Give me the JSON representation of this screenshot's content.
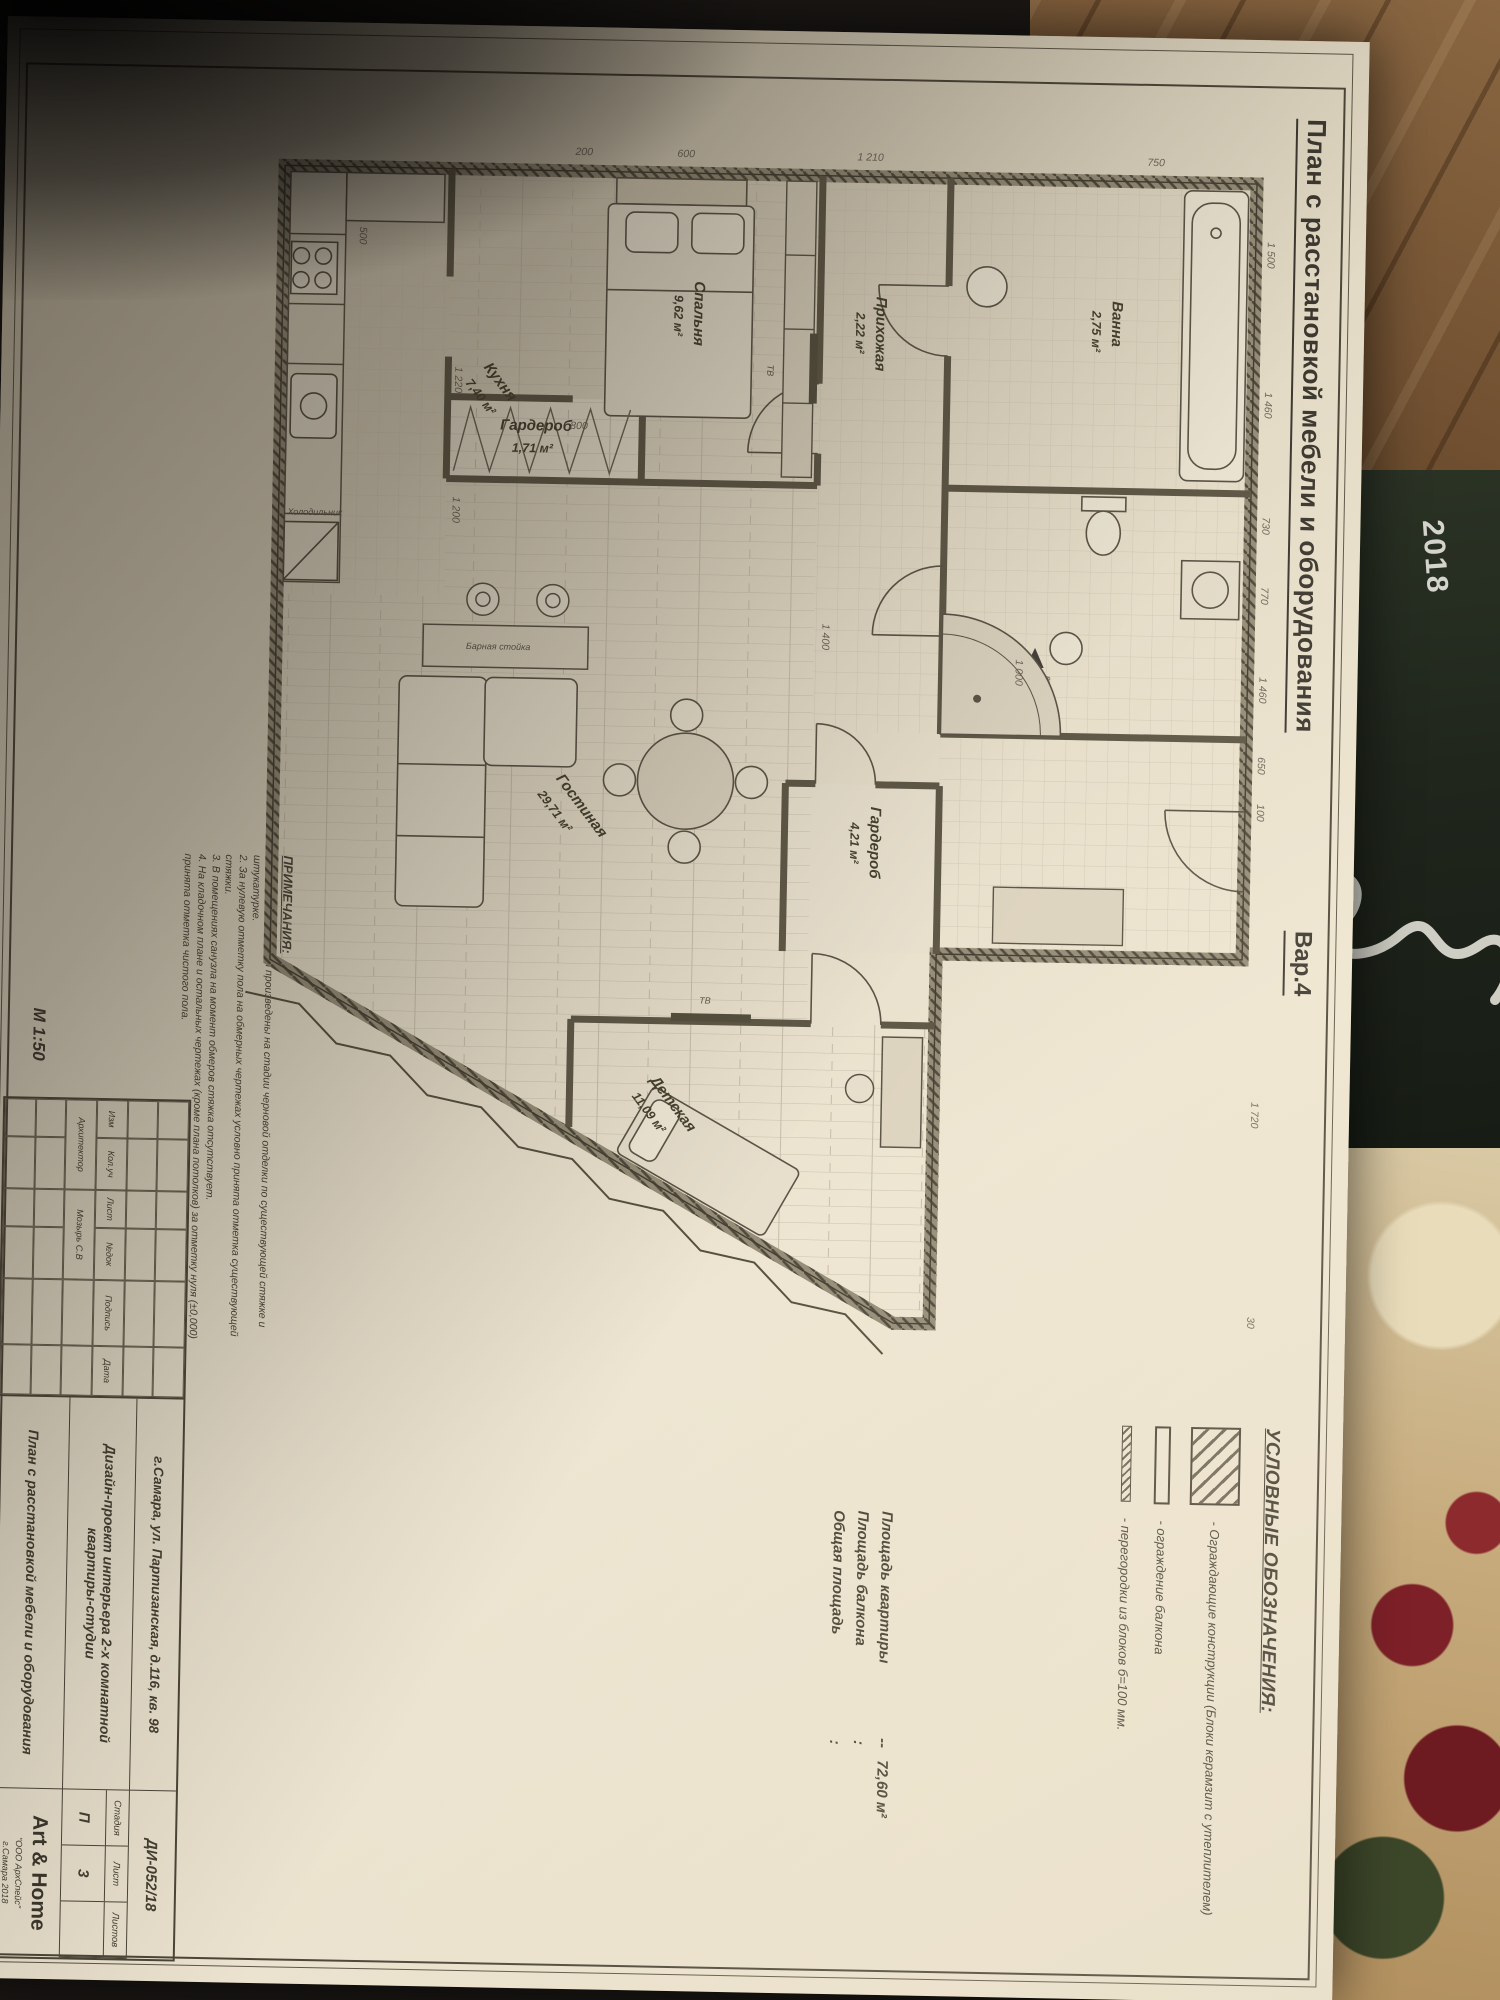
{
  "background": {
    "magazine_year": "2018"
  },
  "sheet": {
    "title": "План с расстановкой мебели и оборудования",
    "variant": "Вар.4",
    "scale": "М 1:50",
    "legend": {
      "heading": "УСЛОВНЫЕ ОБОЗНАЧЕНИЯ:",
      "items": [
        {
          "label": "- Ограждающие конструкции (Блоки керамзит с утеплителем)"
        },
        {
          "label": "- ограждение балкона"
        },
        {
          "label": "- перегородки из блоков б=100 мм."
        }
      ]
    },
    "areas": {
      "rows": [
        {
          "label": "Площадь квартиры",
          "sep": "--",
          "value": "72,60 м²"
        },
        {
          "label": "Площадь балкона",
          "sep": ":",
          "value": ""
        },
        {
          "label": "Общая площадь",
          "sep": ":",
          "value": ""
        }
      ]
    },
    "notes": {
      "heading": "ПРИМЕЧАНИЯ:",
      "items": [
        "1. Обмеры помещения произведены на стадии черновой отделки по существующей стяжке и штукатурке.",
        "2. За нулевую отметку пола на обмерных чертежах условно принята отметка существующей стяжки.",
        "3. В помещениях санузла на момент обмеров стяжка отсутствует.",
        "4. На кладочном плане и остальных чертежах (кроме плана потолков) за отметку нуля (±0,000) принята отметка чистого пола."
      ]
    },
    "stamp": {
      "address": "г.Самара, ул. Партизанская, д.116, кв. 98",
      "doc_no": "ДИ-052/18",
      "project": "Дизайн-проект интерьера 2-х комнатной квартиры-студии",
      "sheet_name": "План с расстановкой мебели и оборудования",
      "stage_label": "Стадия",
      "sheet_label": "Лист",
      "sheets_label": "Листов",
      "stage": "П",
      "sheet_no": "3",
      "sheets_total": "",
      "company": "Art & Home",
      "company_sub": "\"ООО АрхСпейс\"",
      "company_city": "г.Самара 2018",
      "grid": [
        "Изм",
        "Кол.уч",
        "Лист",
        "№док",
        "Подпись",
        "Дата"
      ],
      "role": "Архитектор",
      "role_name": "Мозырь С.В"
    },
    "plan": {
      "rooms": {
        "bath": {
          "name": "Ванна",
          "area": "2,75 м²"
        },
        "hall": {
          "name": "Прихожая",
          "area": "2,22 м²"
        },
        "wardrobe1": {
          "name": "Гардероб",
          "area": "1,71 м²"
        },
        "bedroom": {
          "name": "Спальня",
          "area": "9,62 м²"
        },
        "wardrobe2": {
          "name": "Гардероб",
          "area": "4,21 м²"
        },
        "kitchen": {
          "name": "Кухня",
          "area": "7,40 м²"
        },
        "living": {
          "name": "Гостиная",
          "area": "29,71 м²"
        },
        "kids": {
          "name": "Детская",
          "area": "11,09 м²"
        }
      },
      "labels": {
        "entrance": "вход",
        "bar": "Барная стойка",
        "fridge": "Холодильник",
        "tv": "ТВ"
      },
      "dims": [
        "1 500",
        "1 460",
        "730",
        "770",
        "1 460",
        "650",
        "100",
        "1 720",
        "30",
        "750",
        "1 210",
        "600",
        "200",
        "1 400",
        "1 220",
        "1 200",
        "500",
        "800",
        "1 000"
      ]
    }
  }
}
